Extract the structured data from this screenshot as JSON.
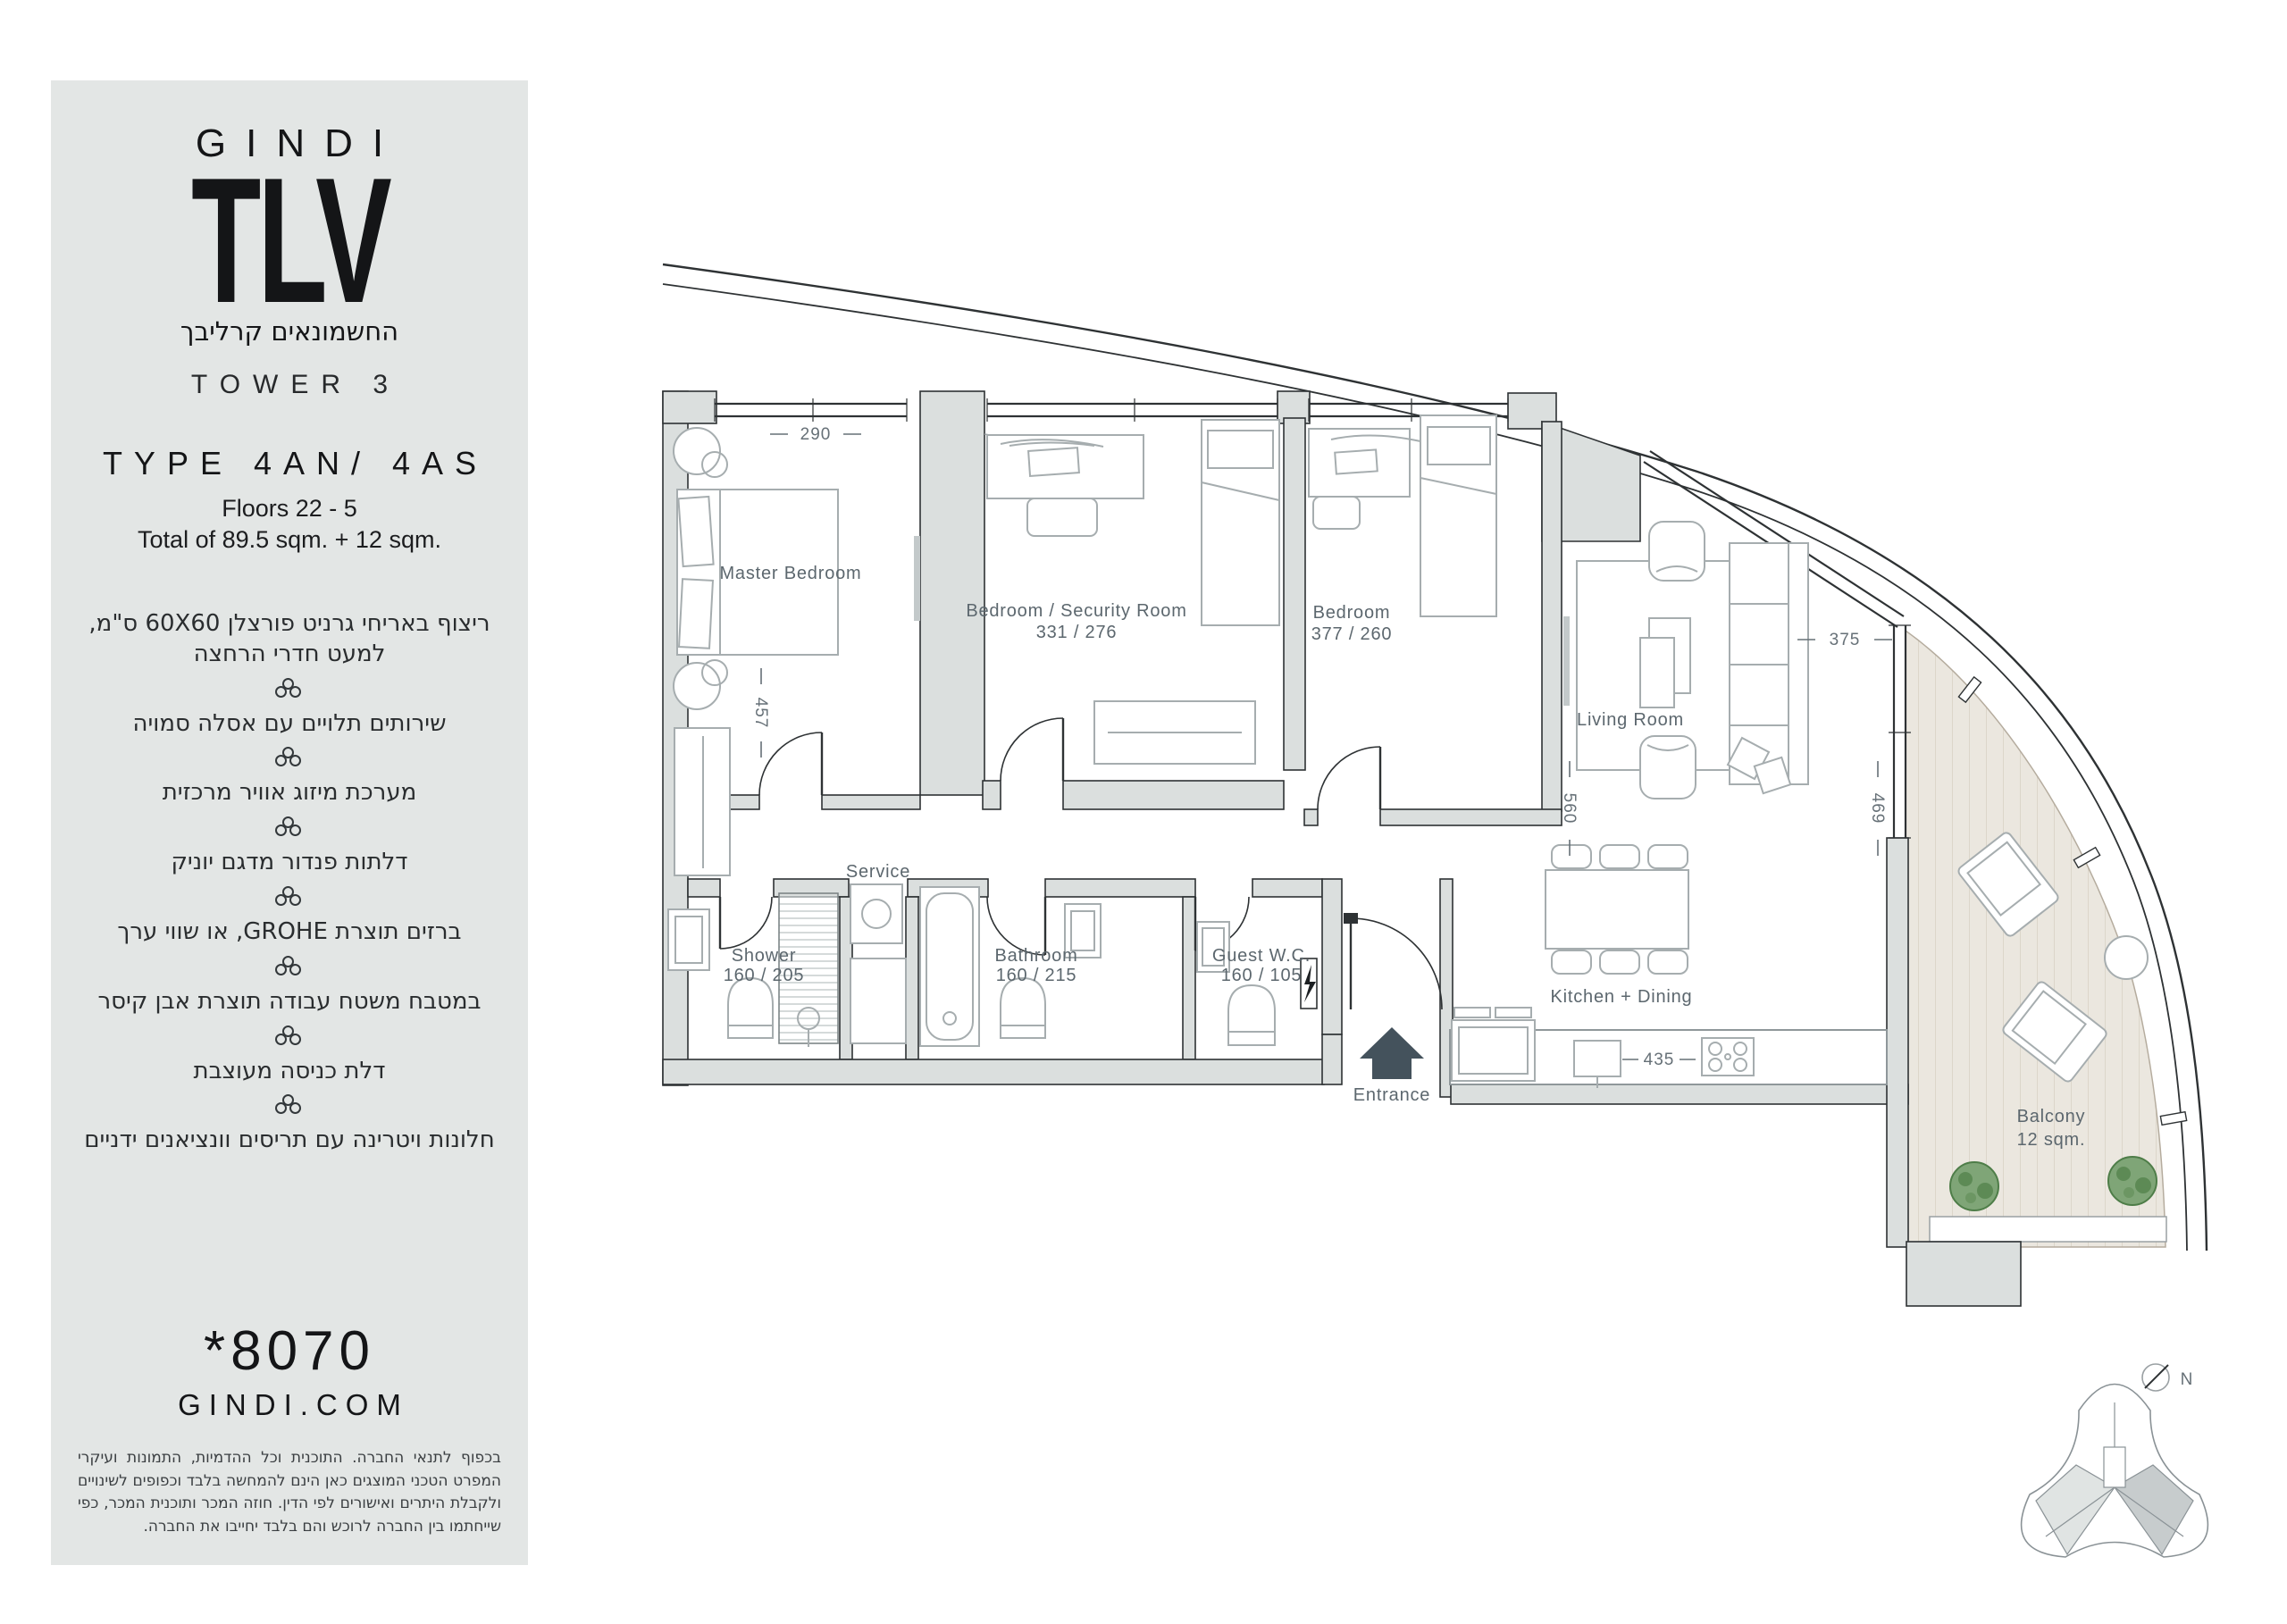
{
  "sidebar": {
    "logo": {
      "line1": "GINDI",
      "line2": "TLV",
      "subtitle_he": "החשמונאים קרליבך"
    },
    "tower": "TOWER 3",
    "unit_type": "TYPE 4AN/ 4AS",
    "floors": "Floors 22 - 5",
    "total_area": "Total of 89.5 sqm. + 12 sqm.",
    "features": [
      "ריצוף באריחי גרניט פורצלן 60X60 ס\"מ, למעט חדרי הרחצה",
      "שירותים תלויים עם אסלה סמויה",
      "מערכת מיזוג אוויר מרכזית",
      "דלתות פנדור מדגם יוניק",
      "ברזים תוצרת GROHE, או שווי ערך",
      "במטבח משטח עבודה תוצרת אבן קיסר",
      "דלת כניסה מעוצבת",
      "חלונות ויטרינה עם תריסים וונציאנים ידניים"
    ],
    "phone": "*8070",
    "website": "GINDI.COM",
    "disclaimer": "בכפוף לתנאי החברה. התוכנית וכל ההדמיות, התמונות ועיקרי המפרט הטכני המוצגים כאן הינם להמחשה בלבד וכפופים לשינויים ולקבלת היתרים ואישורים לפי הדין. חוזה המכר ותוכנית המכר, כפי שייחתמו בין החברה לרוכש והם בלבד יחייבו את החברה."
  },
  "plan": {
    "rooms": {
      "master_bedroom": {
        "name": "Master Bedroom"
      },
      "security_bedroom": {
        "name": "Bedroom / Security Room",
        "dims": "331 / 276"
      },
      "bedroom": {
        "name": "Bedroom",
        "dims": "377 / 260"
      },
      "living_room": {
        "name": "Living  Room"
      },
      "kitchen_dining": {
        "name": "Kitchen + Dining"
      },
      "shower": {
        "name": "Shower",
        "dims": "160 / 205"
      },
      "bathroom": {
        "name": "Bathroom",
        "dims": "160 / 215"
      },
      "guest_wc": {
        "name": "Guest W.C.",
        "dims": "160 / 105"
      },
      "service": {
        "name": "Service"
      },
      "entrance": {
        "name": "Entrance"
      },
      "balcony": {
        "name": "Balcony",
        "area": "12 sqm."
      }
    },
    "dimensions": {
      "mb_width": "290",
      "mb_depth": "457",
      "living_width": "375",
      "living_depth": "560",
      "balcony_depth": "469",
      "counter": "435"
    },
    "compass": {
      "north": "N"
    }
  }
}
